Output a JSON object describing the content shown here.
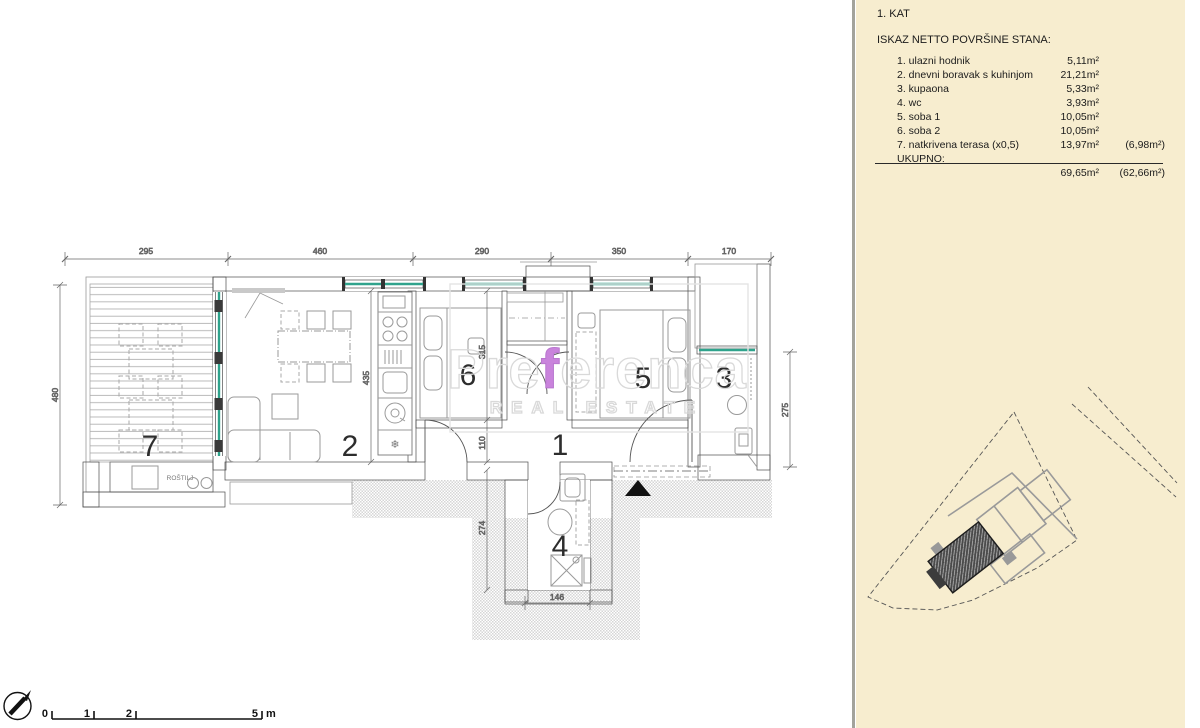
{
  "panel": {
    "floor_label": "1. KAT",
    "title": "ISKAZ NETTO POVRŠINE STANA:",
    "rows": [
      {
        "name": "1. ulazni hodnik",
        "area": "5,11m²",
        "extra": ""
      },
      {
        "name": "2. dnevni boravak s kuhinjom",
        "area": "21,21m²",
        "extra": ""
      },
      {
        "name": "3. kupaona",
        "area": "5,33m²",
        "extra": ""
      },
      {
        "name": "4. wc",
        "area": "3,93m²",
        "extra": ""
      },
      {
        "name": "5. soba 1",
        "area": "10,05m²",
        "extra": ""
      },
      {
        "name": "6. soba 2",
        "area": "10,05m²",
        "extra": ""
      },
      {
        "name": "7. natkrivena terasa (x0,5)",
        "area": "13,97m²",
        "extra": "(6,98m²)"
      }
    ],
    "total_label": "UKUPNO:",
    "total_area": "69,65m²",
    "total_extra": "(62,66m²)",
    "bg_color": "#F7EDCF"
  },
  "plan": {
    "room_labels": [
      "1",
      "2",
      "3",
      "4",
      "5",
      "6",
      "7"
    ],
    "top_dims": [
      "295",
      "460",
      "290",
      "350",
      "170"
    ],
    "left_dim": "480",
    "right_dim": "275",
    "inner_dims": [
      "435",
      "315",
      "110",
      "274",
      "146"
    ],
    "grill_label": "ROŠTILJ",
    "window_color": "#2FA38C",
    "wall_color": "#c9c9c9"
  },
  "watermark": {
    "part1": "Pre",
    "part2": "f",
    "part3": "erenca",
    "subtitle": "REAL ESTATE",
    "accent_color": "#C983DC"
  },
  "scalebar": {
    "labels": [
      "0",
      "1",
      "2",
      "5"
    ],
    "unit": "m"
  }
}
